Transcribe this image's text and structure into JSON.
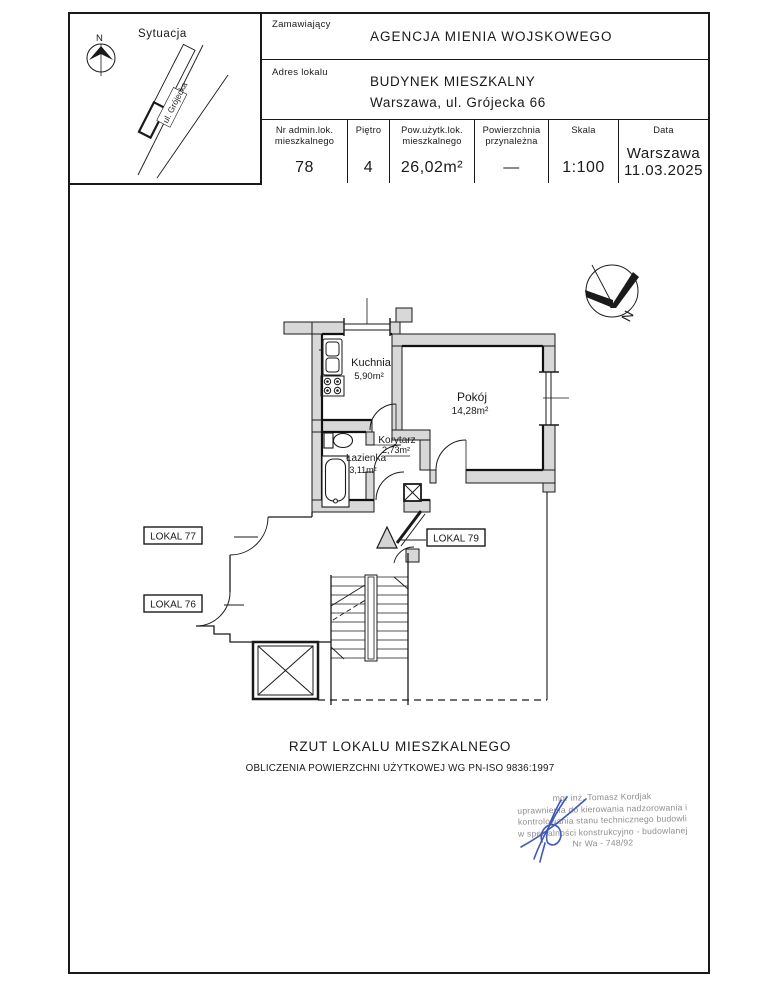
{
  "situation": {
    "title": "Sytuacja",
    "north_label": "N",
    "street_label": "ul. Grójecka"
  },
  "title_block": {
    "client_label": "Zamawiający",
    "client_value": "AGENCJA MIENIA WOJSKOWEGO",
    "address_label": "Adres lokalu",
    "address_line1": "BUDYNEK MIESZKALNY",
    "address_line2": "Warszawa, ul. Grójecka 66",
    "columns": [
      {
        "label": "Nr admin.lok. mieszkalnego",
        "value": "78"
      },
      {
        "label": "Piętro",
        "value": "4"
      },
      {
        "label": "Pow.użytk.lok. mieszkalnego",
        "value": "26,02m²"
      },
      {
        "label": "Powierzchnia przynależna",
        "value": "—"
      },
      {
        "label": "Skala",
        "value": "1:100"
      },
      {
        "label": "Data",
        "value": "Warszawa",
        "value2": "11.03.2025"
      }
    ]
  },
  "plan": {
    "north_label": "N",
    "rooms": [
      {
        "name": "Kuchnia",
        "area": "5,90m²"
      },
      {
        "name": "Pokój",
        "area": "14,28m²"
      },
      {
        "name": "Korytarz",
        "area": "2,73m²"
      },
      {
        "name": "Łazienka",
        "area": "3,11m²"
      }
    ],
    "neighbors": [
      "LOKAL 77",
      "LOKAL 79",
      "LOKAL 76"
    ]
  },
  "caption": {
    "line1": "RZUT LOKALU MIESZKALNEGO",
    "line2": "OBLICZENIA POWIERZCHNI UŻYTKOWEJ WG PN-ISO 9836:1997"
  },
  "stamp": {
    "line1": "mgr inż. Tomasz Kordjak",
    "line2": "uprawnienia do kierowania nadzorowania i",
    "line3": "kontrolowania stanu technicznego budowli",
    "line4": "w specjalności konstrukcyjno - budowlanej",
    "line5": "Nr Wa - 748/92"
  },
  "colors": {
    "line": "#1a1a1a",
    "wall_fill": "#d8d8d8",
    "stamp_gray": "#8e8e8e",
    "signature_blue": "#3f58bb"
  }
}
